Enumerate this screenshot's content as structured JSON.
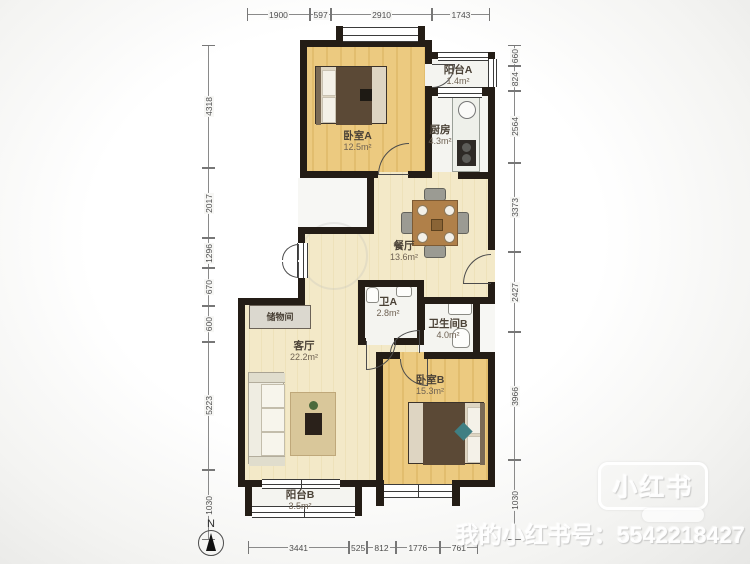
{
  "plan": {
    "north_label": "N",
    "rooms": {
      "bedroomA": {
        "name": "卧室A",
        "area": "12.5m²"
      },
      "balconyA": {
        "name": "阳台A",
        "area": "1.4m²"
      },
      "kitchen": {
        "name": "厨房",
        "area": "4.3m²"
      },
      "dining": {
        "name": "餐厅",
        "area": "13.6m²"
      },
      "bathA": {
        "name": "卫A",
        "area": "2.8m²"
      },
      "bathB": {
        "name": "卫生间B",
        "area": "4.0m²"
      },
      "storage": {
        "name": "储物间"
      },
      "living": {
        "name": "客厅",
        "area": "22.2m²"
      },
      "bedroomB": {
        "name": "卧室B",
        "area": "15.3m²"
      },
      "balconyB": {
        "name": "阳台B",
        "area": "3.5m²"
      }
    },
    "dimensions": {
      "top": [
        "1900",
        "597",
        "2910",
        "1743"
      ],
      "left": [
        "4318",
        "2017",
        "1296",
        "670",
        "600",
        "5223",
        "1030"
      ],
      "right": [
        "660",
        "824",
        "2564",
        "3373",
        "2427",
        "3966",
        "1030"
      ],
      "bottom": [
        "3441",
        "525",
        "812",
        "1776",
        "761"
      ]
    }
  },
  "watermark": {
    "logo_text": "小红书",
    "caption": "我的小红书号：5542218427"
  },
  "colors": {
    "wall": "#241d16",
    "wood_floor": "#ecca80",
    "cream_floor": "#f2e8c6",
    "white_floor": "#f4f4f0"
  }
}
